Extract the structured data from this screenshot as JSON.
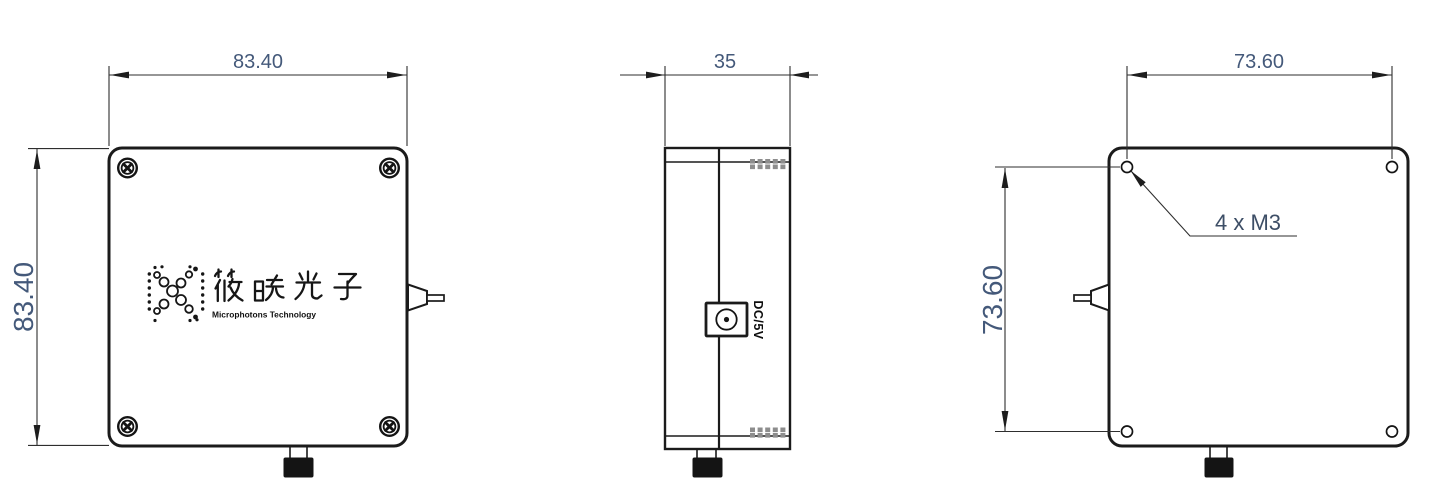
{
  "colors": {
    "line": "#1b1b1b",
    "dim": "#44597a",
    "knurl": "#8d8d8d",
    "fill-dark": "#141414"
  },
  "views": {
    "front": {
      "width_dim": "83.40",
      "height_dim": "83.40"
    },
    "side": {
      "width_dim": "35",
      "dc_port_label": "DC/5V"
    },
    "back": {
      "width_dim": "73.60",
      "height_dim": "73.60",
      "holes_note": "4 x M3"
    }
  },
  "logo": {
    "cjk": "筱晓光子",
    "latin": "Microphotons Technology"
  },
  "icons": {
    "screw": "phillips-screw-icon",
    "mounting_hole": "m3-hole-icon",
    "dc_jack": "dc-power-jack-icon",
    "fiber_connector": "fiber-pigtail-connector-icon",
    "bottom_nut": "connector-nut-icon",
    "knurl_mark": "knurled-screw-side-icon",
    "logo_mark": "x-dots-logo-icon"
  }
}
